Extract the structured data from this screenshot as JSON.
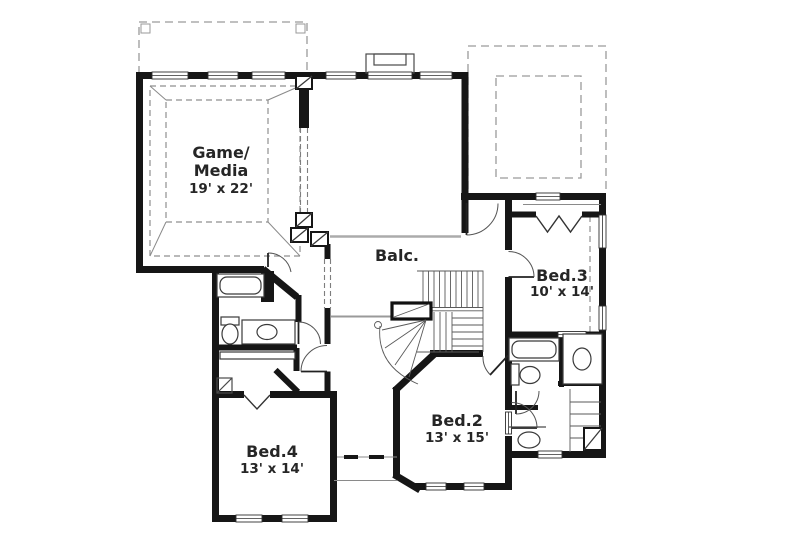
{
  "rooms": {
    "game_media": {
      "name_line1": "Game/",
      "name_line2": "Media",
      "size": "19' x 22'"
    },
    "balcony": {
      "name": "Balc."
    },
    "bed2": {
      "name": "Bed.2",
      "size": "13' x 15'"
    },
    "bed3": {
      "name": "Bed.3",
      "size": "10' x 14'"
    },
    "bed4": {
      "name": "Bed.4",
      "size": "13' x 14'"
    }
  },
  "colors": {
    "walls": "#161616",
    "thin_lines": "#4a4a4a",
    "dashed_outlines": "#9a9a9a",
    "balcony_rail": "#ababab",
    "label_text": "#262626",
    "background": "#ffffff"
  }
}
